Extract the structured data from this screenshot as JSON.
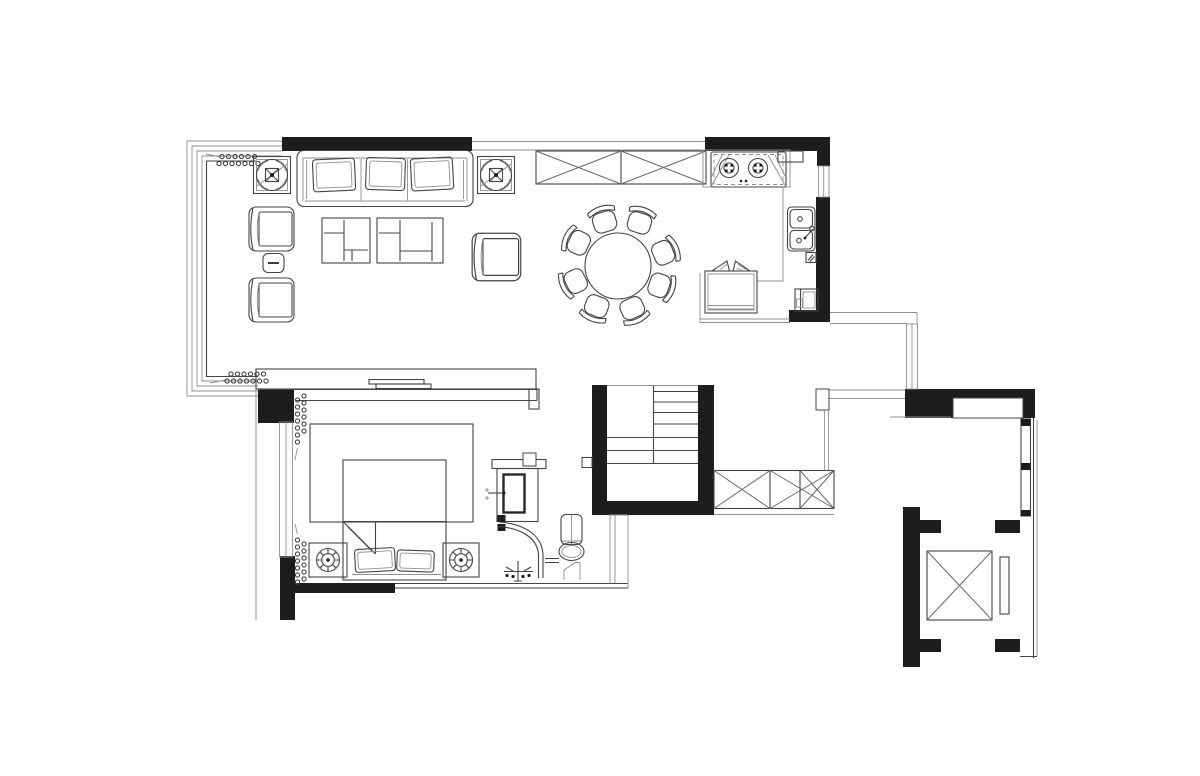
{
  "canvas": {
    "width": 1200,
    "height": 776,
    "background": "#ffffff"
  },
  "colors": {
    "bg": "#ffffff",
    "wall": "#1d1d1d",
    "line": "#444444",
    "line-mid": "#6a6a6a",
    "line-light": "#8f8f8f",
    "accent-dark": "#262626"
  },
  "drawing": {
    "kind": "residential floor plan, top-down line drawing, no text labels visible",
    "rooms": [
      {
        "id": "living-dining",
        "elements": [
          "ceiling-fan",
          "ceiling-fan",
          "three-seat-sofa",
          "sofa-cushion",
          "sofa-cushion",
          "sofa-cushion",
          "coffee-table",
          "coffee-table",
          "lounge-armchair",
          "lounge-armchair",
          "side-table",
          "bay-window",
          "curtain-bead-row",
          "round-dining-table",
          "dining-chair",
          "dining-chair",
          "dining-chair",
          "dining-chair",
          "dining-chair",
          "dining-chair",
          "dining-chair",
          "dining-chair",
          "dining-armchair",
          "x-front-sideboard"
        ]
      },
      {
        "id": "kitchen",
        "elements": [
          "two-burner-cooktop",
          "countertop",
          "counter-box",
          "double-sink",
          "faucet",
          "floor-drain",
          "island-cabinet",
          "dish-rack",
          "service-cabinet",
          "window"
        ]
      },
      {
        "id": "stair-hall",
        "elements": [
          "staircase-up",
          "x-brace-railing",
          "handrail-post",
          "corridor-window",
          "wall-opening"
        ]
      },
      {
        "id": "bedroom",
        "elements": [
          "sliding-wardrobe",
          "area-rug",
          "double-bed",
          "blanket-fold",
          "pillow",
          "pillow",
          "nightstand-lamp",
          "nightstand-lamp",
          "window",
          "curtain-bead-column"
        ]
      },
      {
        "id": "bathroom",
        "elements": [
          "door-leaf",
          "door-frame",
          "glass-shower-screen",
          "shower-set",
          "toilet"
        ]
      },
      {
        "id": "elevator-lobby",
        "elements": [
          "sliding-door",
          "threshold-line",
          "wall-niche"
        ]
      },
      {
        "id": "elevator",
        "elements": [
          "shaft-x-mark",
          "elevator-door-panel",
          "shaft-walls"
        ]
      }
    ]
  }
}
